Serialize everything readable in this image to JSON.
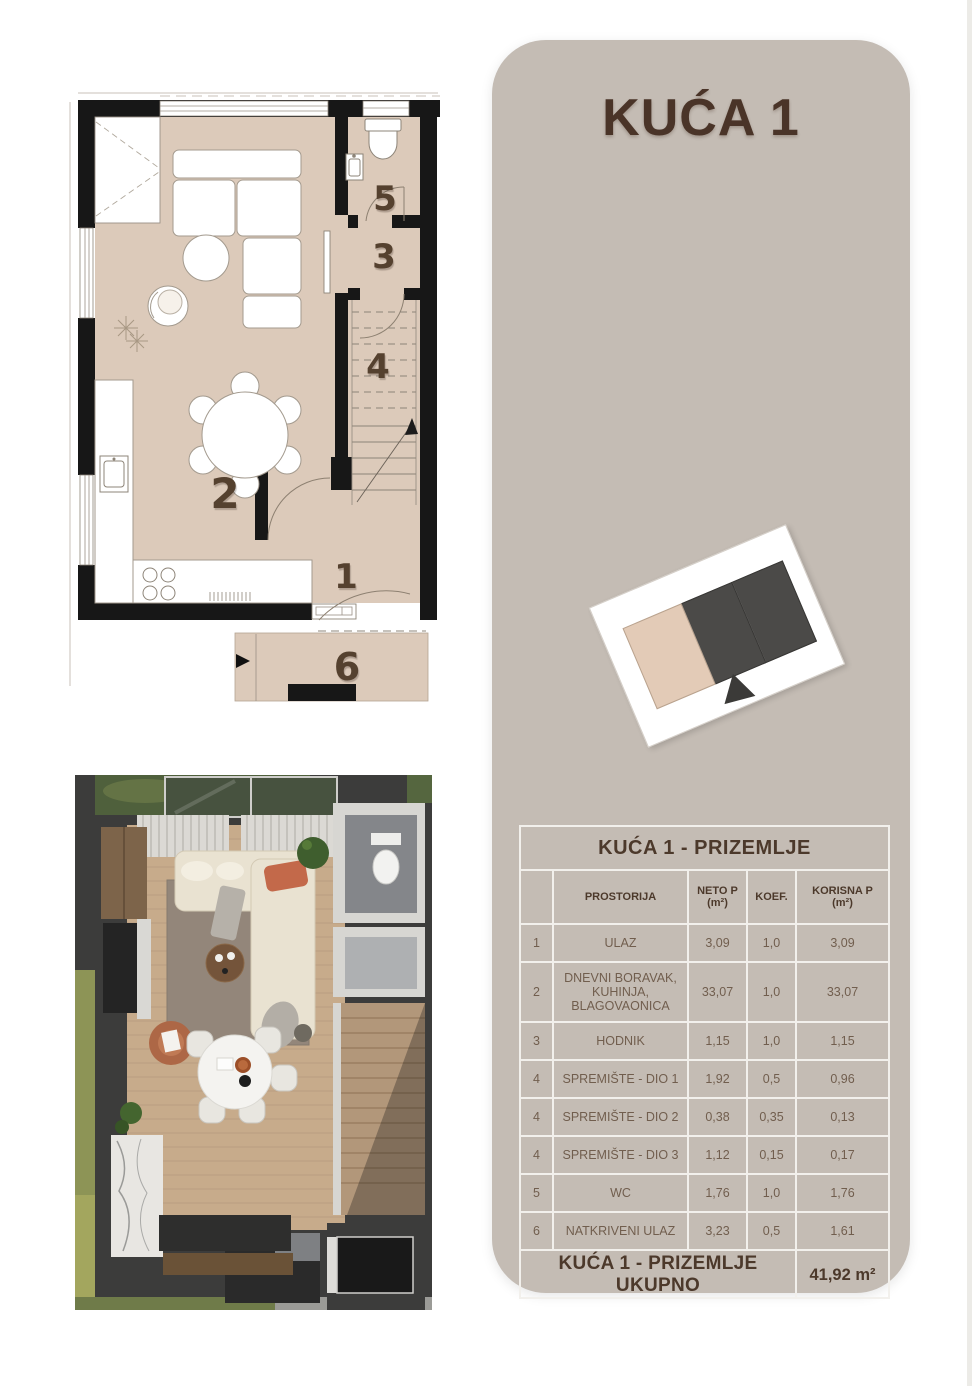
{
  "panel": {
    "title": "KUĆA 1",
    "bg_color": "#c4bcb4",
    "title_color": "#4a3428"
  },
  "site_plan": {
    "highlight_unit_color": "#e3cbb7",
    "other_unit_color": "#4b4a48"
  },
  "floor_plan": {
    "floor_color": "#dccaba",
    "wall_color": "#171717",
    "rooms": {
      "n1": "1",
      "n2": "2",
      "n3": "3",
      "n4": "4",
      "n5": "5",
      "n6": "6"
    }
  },
  "table": {
    "title": "KUĆA 1 - PRIZEMLJE",
    "columns": {
      "num": "",
      "room": "PROSTORIJA",
      "neto": "NETO P\n(m²)",
      "koef": "KOEF.",
      "korisna": "KORISNA P\n(m²)"
    },
    "rows": [
      {
        "num": "1",
        "room": "ULAZ",
        "neto": "3,09",
        "koef": "1,0",
        "korisna": "3,09"
      },
      {
        "num": "2",
        "room": "DNEVNI BORAVAK,\nKUHINJA,\nBLAGOVAONICA",
        "neto": "33,07",
        "koef": "1,0",
        "korisna": "33,07"
      },
      {
        "num": "3",
        "room": "HODNIK",
        "neto": "1,15",
        "koef": "1,0",
        "korisna": "1,15"
      },
      {
        "num": "4",
        "room": "SPREMIŠTE - DIO 1",
        "neto": "1,92",
        "koef": "0,5",
        "korisna": "0,96"
      },
      {
        "num": "4",
        "room": "SPREMIŠTE - DIO 2",
        "neto": "0,38",
        "koef": "0,35",
        "korisna": "0,13"
      },
      {
        "num": "4",
        "room": "SPREMIŠTE - DIO 3",
        "neto": "1,12",
        "koef": "0,15",
        "korisna": "0,17"
      },
      {
        "num": "5",
        "room": "WC",
        "neto": "1,76",
        "koef": "1,0",
        "korisna": "1,76"
      },
      {
        "num": "6",
        "room": "NATKRIVENI ULAZ",
        "neto": "3,23",
        "koef": "0,5",
        "korisna": "1,61"
      }
    ],
    "footer": {
      "label": "KUĆA 1 - PRIZEMLJE UKUPNO",
      "total": "41,92 m²"
    }
  }
}
